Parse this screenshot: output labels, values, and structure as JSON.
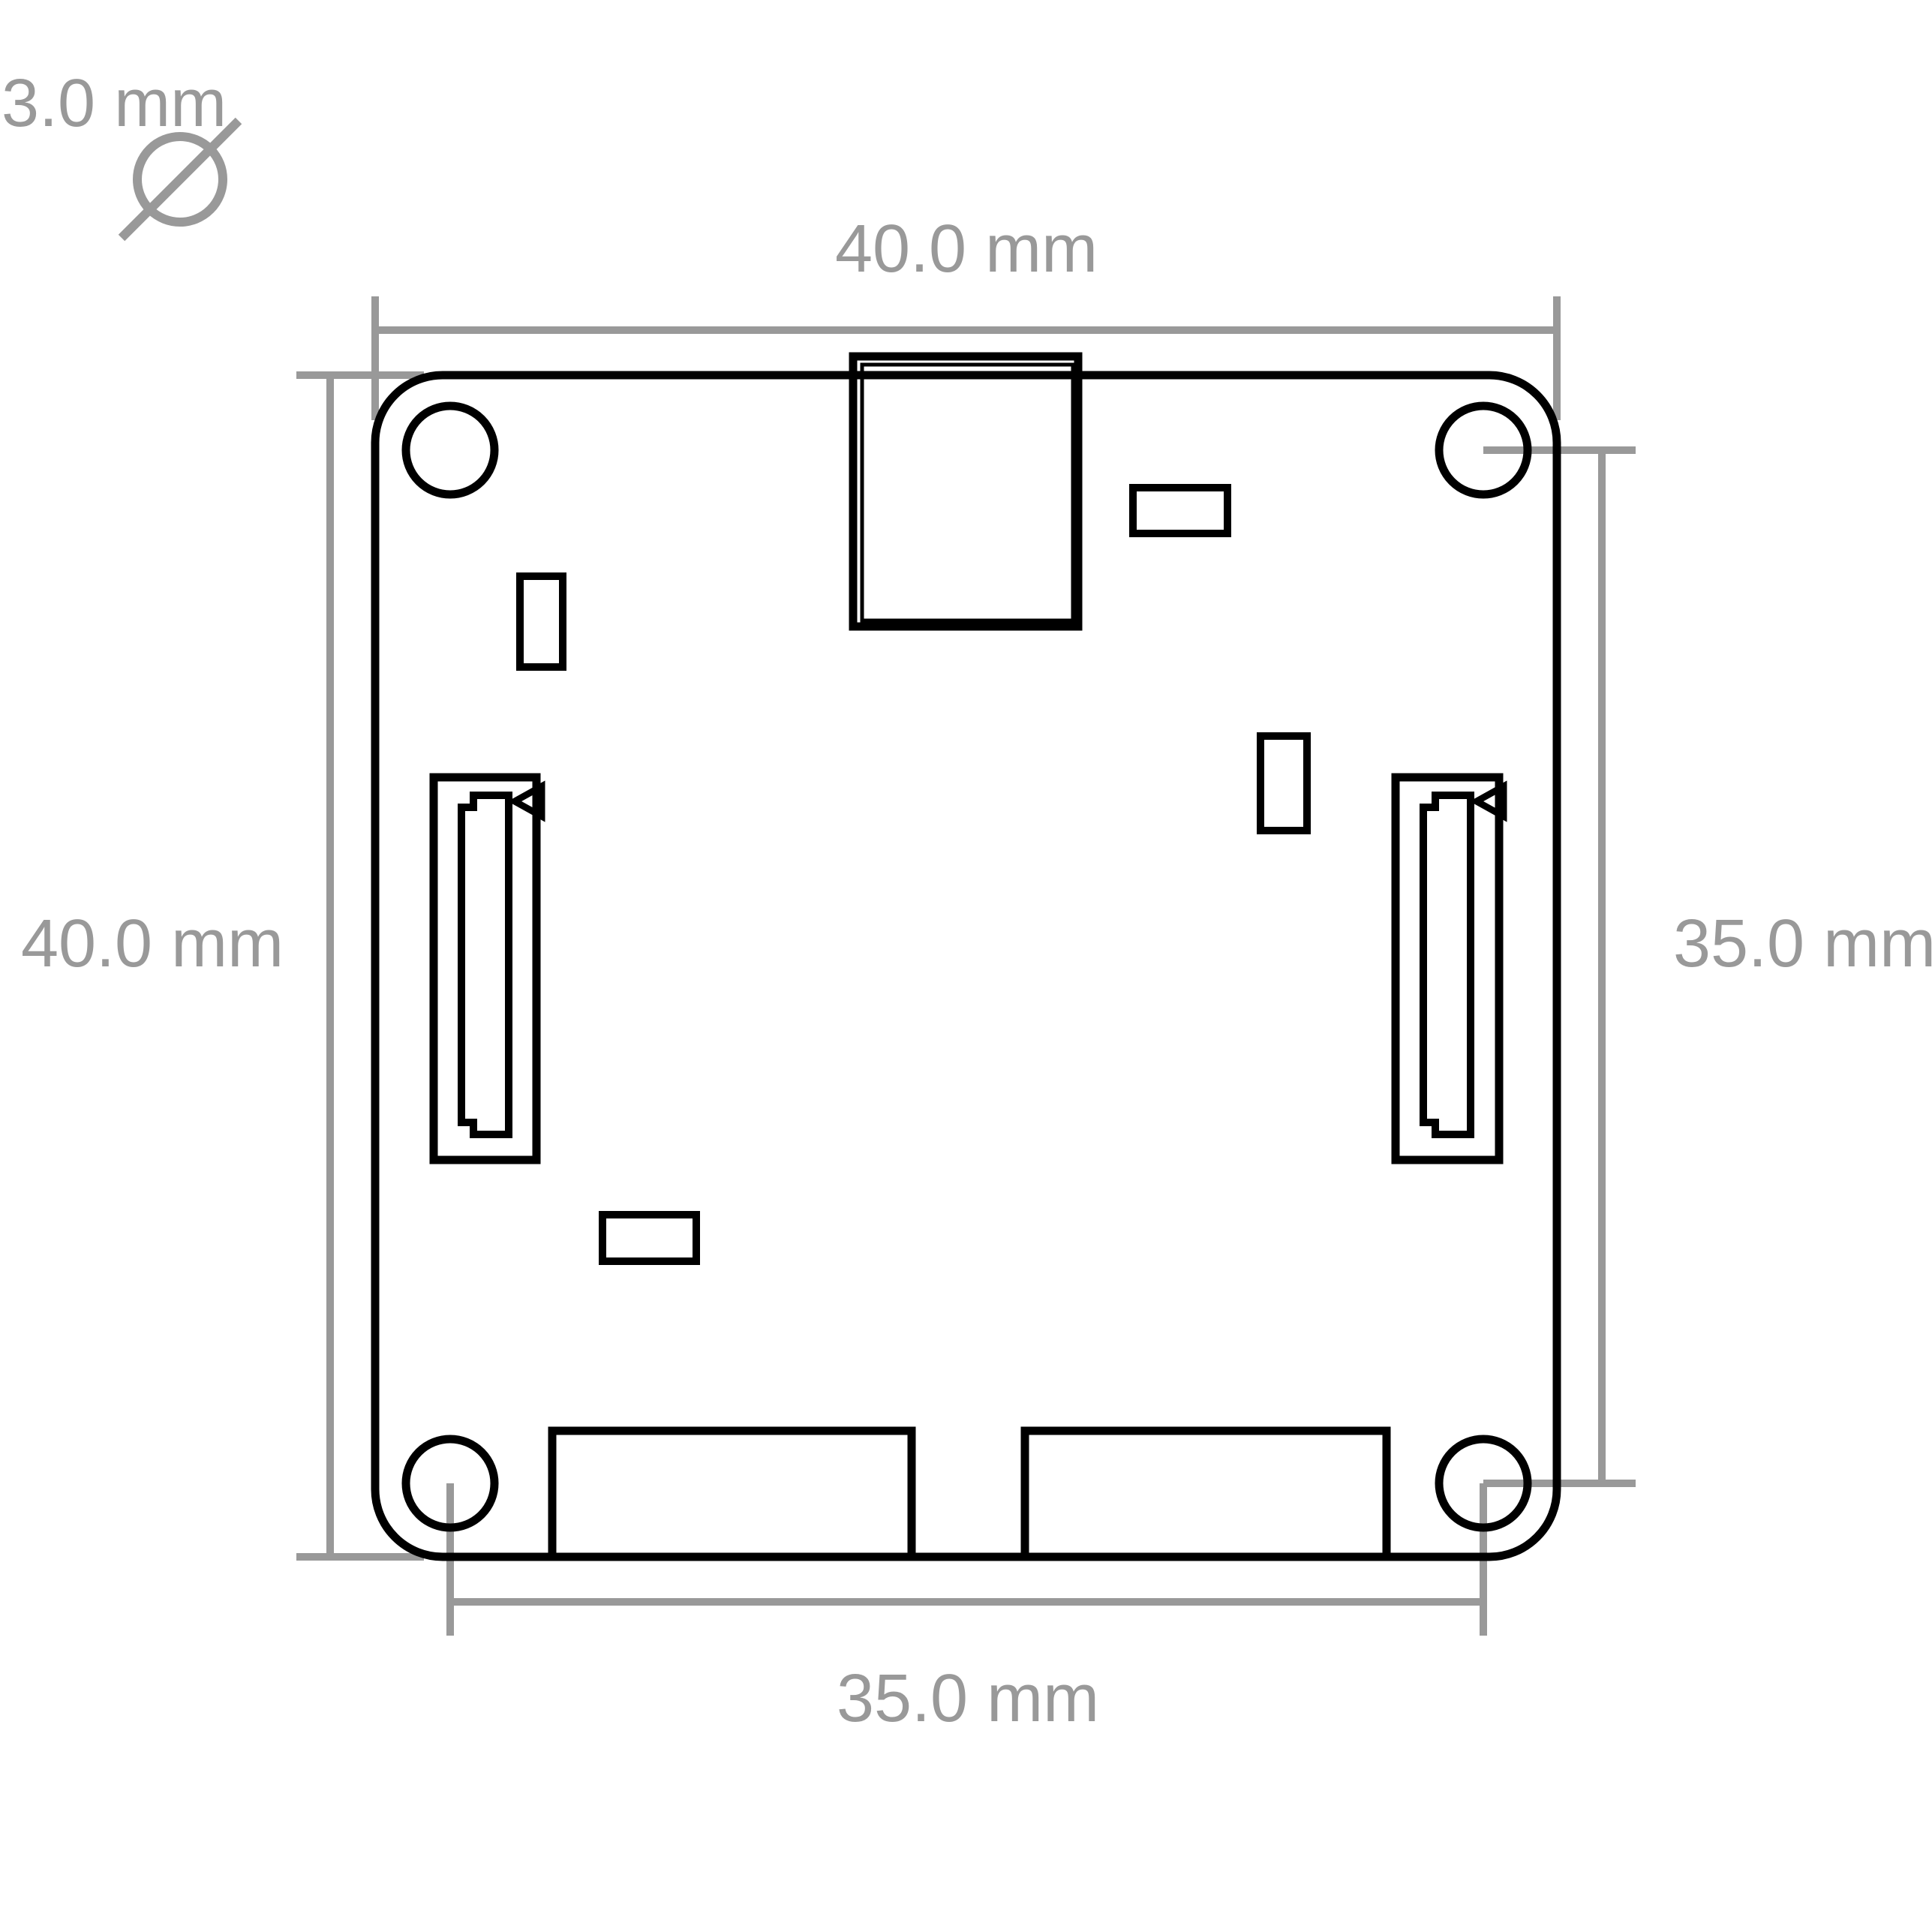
{
  "drawing": {
    "type": "pcb-mechanical-dimension-drawing",
    "units": "mm",
    "colors": {
      "outline": "#000000",
      "dimension": "#999999",
      "background": "#ffffff"
    },
    "dimensions": {
      "board_width": {
        "label": "40.0 mm",
        "value_mm": 40.0,
        "orientation": "horizontal",
        "position": "top"
      },
      "board_height": {
        "label": "40.0 mm",
        "value_mm": 40.0,
        "orientation": "vertical",
        "position": "left"
      },
      "hole_spacing_vertical": {
        "label": "35.0 mm",
        "value_mm": 35.0,
        "orientation": "vertical",
        "position": "right"
      },
      "hole_spacing_horizontal": {
        "label": "35.0 mm",
        "value_mm": 35.0,
        "orientation": "horizontal",
        "position": "bottom"
      },
      "hole_diameter": {
        "label": "3.0 mm",
        "value_mm": 3.0,
        "symbol": "Ø",
        "position": "top-left"
      }
    }
  }
}
